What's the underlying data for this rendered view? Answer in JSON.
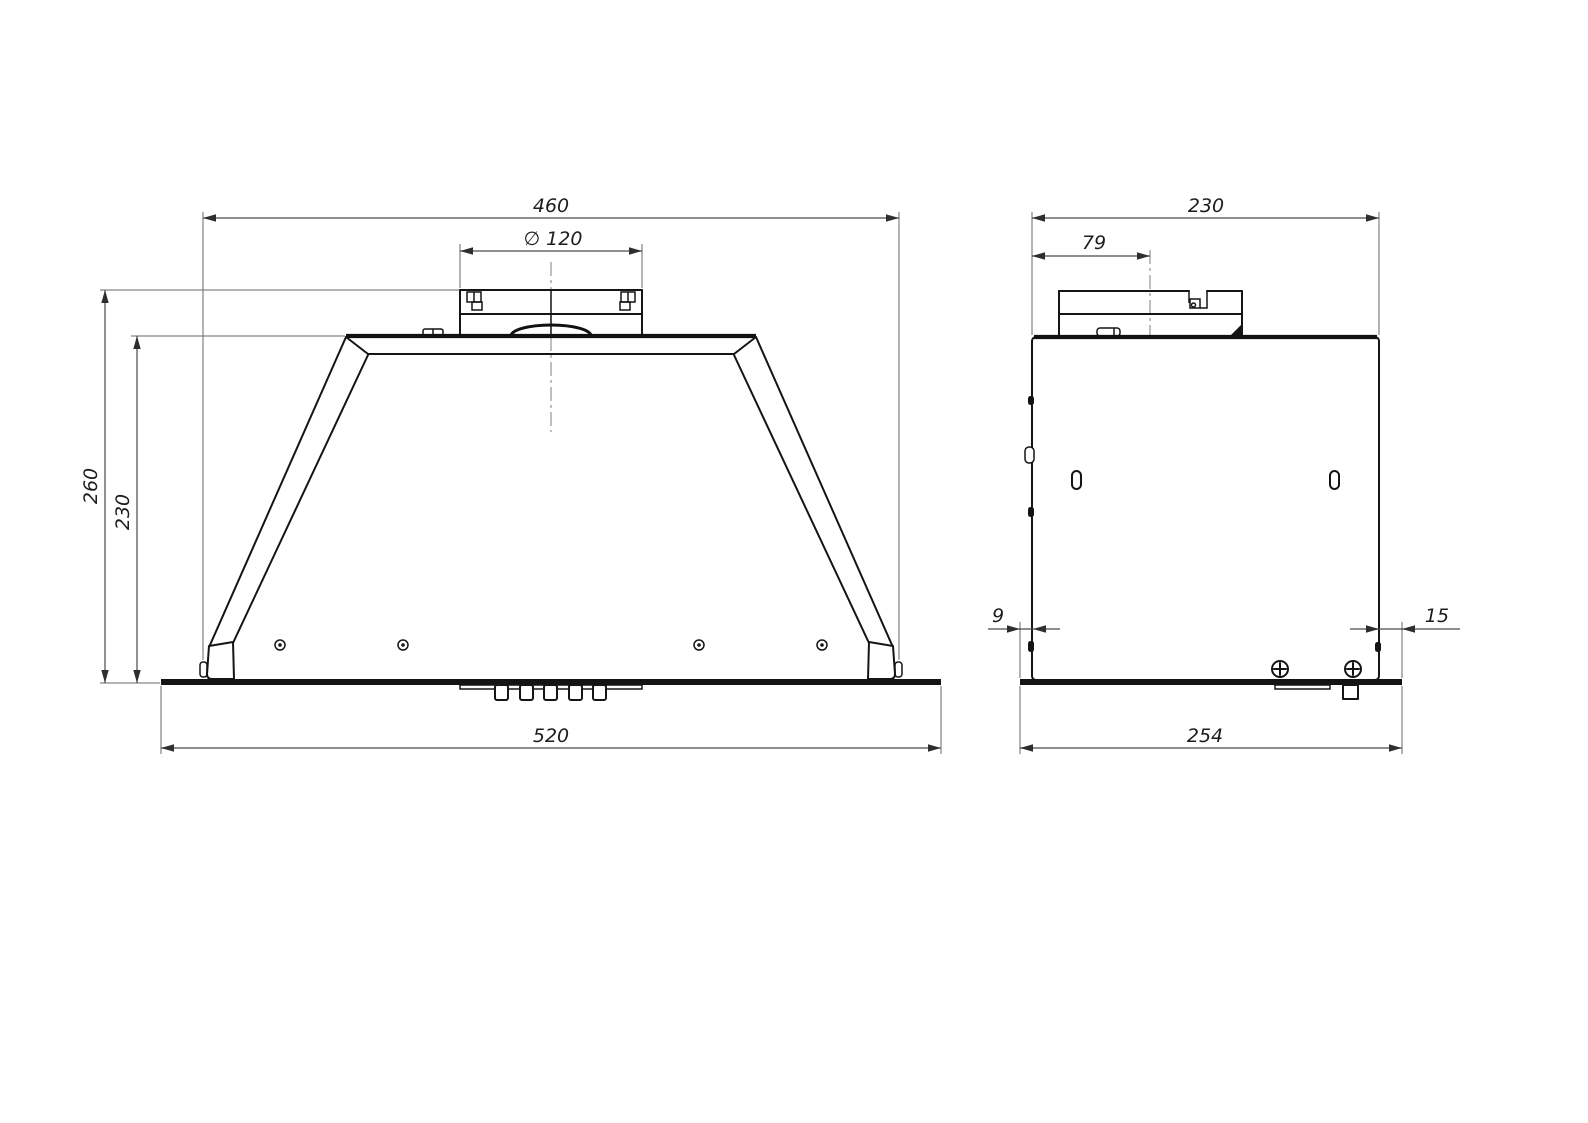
{
  "drawing": {
    "type": "technical-drawing",
    "subject": "built-in cooker hood, two orthographic views",
    "line_color": "#151515",
    "dim_color": "#4a4a4a",
    "background": "#ffffff",
    "front_view": {
      "dimensions": {
        "body_width": "460",
        "duct_diameter": "∅ 120",
        "overall_height": "260",
        "body_height": "230",
        "panel_width": "520"
      }
    },
    "side_view": {
      "dimensions": {
        "body_depth": "230",
        "duct_offset": "79",
        "rear_gap": "9",
        "front_gap": "15",
        "panel_depth": "254"
      }
    }
  }
}
